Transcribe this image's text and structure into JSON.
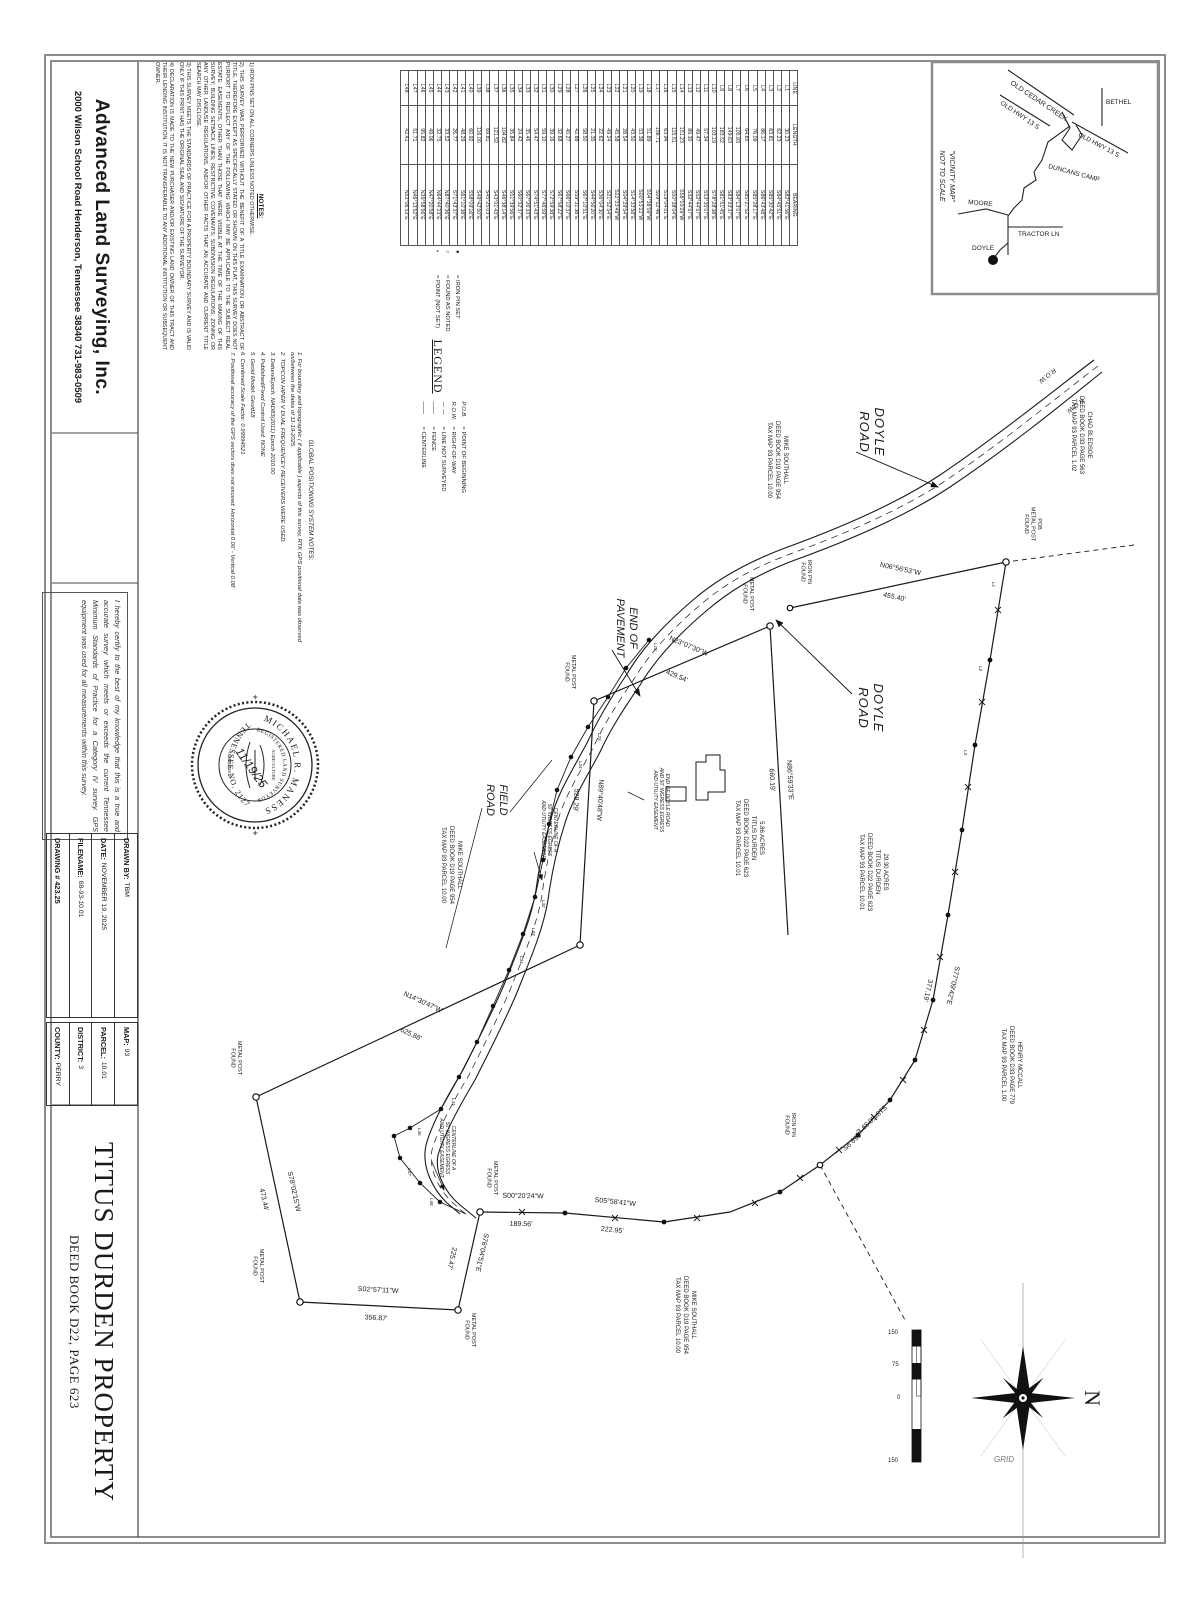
{
  "company": {
    "name": "Advanced Land Surveying, Inc.",
    "address": "2000 Wilson School Road   Henderson, Tennessee  38340    731-983-0509"
  },
  "notes": {
    "heading": "NOTES:",
    "items": [
      "1) IRON PINS SET ON ALL CORNERS UNLESS NOTED OTHERWISE.",
      "2) THIS SURVEY WAS PERFORMED WITHOUT THE BENEFIT OF A TITLE EXAMINATION OR ABSTRACT OF TITLE, THEREFORE EXCEPT AS SPECIFICALLY STATED OR SHOWN ON THIS PLAT, THIS SURVEY DOES NOT PURPORT TO REFLECT ANY OF THE FOLLOWING WHICH MAY BE APPLICABLE TO THE SUBJECT REAL ESTATE: EASEMENTS, OTHER THAN THOSE THAT WERE VISIBLE AT THE TIME OF THE MAKING OF THIS SURVEY; BUILDING SETBACK LINES; RESTRICTIVE COVENANTS; SUBDIVISION REGULATIONS; ZONING OR ANY OTHER LANDUSE REGULATIONS, AND/OR OTHER FACTS THAT AN ACCURATE AND CURRENT TITLE SEARCH MAY DISCLOSE.",
      "3) THIS SURVEY MEETS THE STANDARDS OF PRACTICE FOR A PROPERTY BOUNDARY SURVEY AND IS VALID ONLY IF THIS PRINT HAS THE ORIGINAL SEAL AND SIGNATURE OF THE SURVEYOR.",
      "4) DECLARATION IS MADE TO THE NEW PURCHASER AND/OR EXISTING LAND OWNER OF THIS TRACT AND THEIR LENDING INSTITUTION. IT IS NOT TRANSFERABLE TO ANY ADDITIONAL INSTITUTION OR SUBSEQUENT OWNER."
    ]
  },
  "gps_notes": {
    "heading": "GLOBAL POSITIONING SYSTEM NOTES:",
    "items": [
      "1.  For boundary and topographic ( if applicable ) aspects of this survey, RTK GPS positional data was observed on/between the dates of 11-19-2025.",
      "2.  TOPCON HIPER V DUAL FREQUENCEY RECEIVERS WERE USED.",
      "3.  Datum/Epoch:  NAD83(2011) Epoch 2010.00",
      "4.  Published/Fixed Control Used:  NONE",
      "5.  Geoid Model:   Geoid18",
      "6.  Combined Scale Factor:  0.99994521",
      "7.  Positional accuracy of the GPS vectors does not exceed:  Horizontal 0.06'  -  Vertical 0.08'"
    ]
  },
  "legend": {
    "heading": "LEGEND",
    "symbol_items": [
      {
        "sym": "●",
        "text": "= IRON PIN SET"
      },
      {
        "sym": "○",
        "text": "= FOUND AS NOTED"
      },
      {
        "sym": "•",
        "text": "= POINT (NOT SET)"
      }
    ],
    "abbrev_items": [
      {
        "sym": "P.O.B.",
        "text": "= POINT OF BEGINNING"
      },
      {
        "sym": "R.O.W.",
        "text": "= RIGHT-OF-WAY"
      },
      {
        "sym": "— —",
        "text": "= LINE NOT SURVEYED"
      },
      {
        "sym": "───",
        "text": "= FENCE"
      },
      {
        "sym": "───",
        "text": "= CENTERLINE"
      }
    ]
  },
  "line_table": {
    "headers": [
      "LINE",
      "LENGTH",
      "BEARING"
    ],
    "rows": [
      [
        "L1",
        "30.23",
        "S82°41'56\"E"
      ],
      [
        "L2",
        "62.23",
        "S84°45'51\"E"
      ],
      [
        "L3",
        "63.81",
        "S85°30'42\"E"
      ],
      [
        "L4",
        "86.17",
        "S86°43'48\"E"
      ],
      [
        "L5",
        "76.09",
        "S85°28'17\"E"
      ],
      [
        "L6",
        "64.65",
        "S85°27'52\"E"
      ],
      [
        "L7",
        "105.93",
        "S84°13'07\"E"
      ],
      [
        "L8",
        "149.63",
        "S83°33'37\"E"
      ],
      [
        "L9",
        "183.52",
        "S81°51'45\"E"
      ],
      [
        "L10",
        "103.19",
        "S78°28'38\"E"
      ],
      [
        "L11",
        "57.34",
        "S53°35'07\"E"
      ],
      [
        "L12",
        "49.47",
        "S52°44'57\"E"
      ],
      [
        "L13",
        "89.30",
        "S32°44'57\"E"
      ],
      [
        "L14",
        "151.23",
        "S58°03'29\"W"
      ],
      [
        "L15",
        "115.51",
        "S50°38'04\"E"
      ],
      [
        "L16",
        "63.94",
        "S19°04'01\"E"
      ],
      [
        "L17",
        "156.71",
        "S09°52'46\"E"
      ],
      [
        "L18",
        "51.89",
        "S04°38'09\"W"
      ],
      [
        "L19",
        "53.38",
        "S00°53'22\"W"
      ],
      [
        "L20",
        "43.50",
        "S14°33'58\"E"
      ],
      [
        "L21",
        "28.54",
        "S04°29'54\"E"
      ],
      [
        "L22",
        "45.58",
        "S22°23'49\"W"
      ],
      [
        "L23",
        "49.24",
        "S21°52'54\"E"
      ],
      [
        "L24",
        "22.62",
        "S36°04'30\"E"
      ],
      [
        "L25",
        "21.35",
        "S44°56'20\"E"
      ],
      [
        "L26",
        "58.50",
        "S67°10'51\"E"
      ],
      [
        "L27",
        "42.88",
        "S59°31'38\"E"
      ],
      [
        "L28",
        "40.27",
        "S66°10'37\"E"
      ],
      [
        "L29",
        "32.68",
        "S67°58'22\"E"
      ],
      [
        "L30",
        "39.16",
        "S72°59'38\"E"
      ],
      [
        "L31",
        "59.10",
        "S77°46'59\"E"
      ],
      [
        "L32",
        "54.47",
        "S74°51'43\"E"
      ],
      [
        "L33",
        "35.46",
        "S67°26'33\"E"
      ],
      [
        "L34",
        "24.42",
        "S60°32'37\"E"
      ],
      [
        "L35",
        "35.84",
        "S51°39'56\"E"
      ],
      [
        "L36",
        "104.82",
        "S46°38'14\"E"
      ],
      [
        "L37",
        "121.52",
        "S43°01'43\"E"
      ],
      [
        "L38",
        "69.81",
        "S45°25'03\"E"
      ],
      [
        "L39",
        "116.00",
        "S49°42'50\"E"
      ],
      [
        "L40",
        "60.92",
        "S58°09'16\"E"
      ],
      [
        "L41",
        "48.29",
        "S61°10'38\"E"
      ],
      [
        "L42",
        "26.77",
        "S71°43'37\"E"
      ],
      [
        "L43",
        "33.52",
        "N87°40'36\"E"
      ],
      [
        "L44",
        "32.75",
        "N64°44'23\"E"
      ],
      [
        "L45",
        "49.06",
        "N47°20'58\"E"
      ],
      [
        "L46",
        "95.82",
        "N39°58'56\"E"
      ],
      [
        "L47",
        "51.71",
        "N46°13'52\"E"
      ],
      [
        "L48",
        "42.41",
        "N53°06'53\"E"
      ]
    ]
  },
  "vicinity": {
    "caption1": "\"VICINITY MAP\"",
    "caption2": "NOT TO SCALE",
    "roads": {
      "old_cedar_creek": "OLD CEDAR CREEK",
      "old_hwy_1": "OLD HWY 13 S",
      "old_hwy_2": "OLD HWY 13 S",
      "bethel": "BETHEL",
      "duncans_camp": "DUNCANS CAMP",
      "moore": "MOORE",
      "tractor_ln": "TRACTOR LN",
      "doyle": "DOYLE"
    }
  },
  "certification": "I hereby certify to the best of my knowledge that this is a true and accurate survey which meets or exceeds the current Tennessee Minimum Standards of Practice for a Category IV survey. GPS equipment was used for all measurements within this survey.",
  "seal": {
    "name": "MICHAEL R. MANESS",
    "reg": "REGISTERED LAND SURVEYOR",
    "state": "TENNESSEE NO. 2127",
    "agriculture": "AGRICULTURE",
    "commerce": "COMMERCE",
    "date": "11/19/25",
    "plus": "+"
  },
  "title_block": {
    "drawn_by_label": "DRAWN BY:",
    "drawn_by": "TBM",
    "date_label": "DATE:",
    "date": "NOVEMBER 19, 2025",
    "filename_label": "FILENAME:",
    "filename": "68-93-10.01",
    "drawing_no": "DRAWING # 423.25",
    "map_label": "MAP:",
    "map": "93",
    "parcel_label": "PARCEL:",
    "parcel": "10.01",
    "district_label": "DISTRICT:",
    "district": "3",
    "county_label": "COUNTY:",
    "county": "PERRY"
  },
  "title": {
    "line1": "TITUS DURDEN PROPERTY",
    "line2": "DEED BOOK D22, PAGE 623"
  },
  "compass": {
    "north": "N",
    "grid": "GRID"
  },
  "scale_bar": {
    "labels": [
      "150",
      "75",
      "0",
      "150"
    ]
  },
  "drawing": {
    "labels": {
      "doyle_road": [
        "DOYLE",
        "ROAD"
      ],
      "field_road": [
        "FIELD",
        "ROAD"
      ],
      "end_of_pavement": [
        "END OF",
        "PAVEMENT"
      ],
      "row_label": "R.O.W.",
      "pob": [
        "POB",
        "METAL POST",
        "FOUND"
      ],
      "metal_post": [
        "METAL POST",
        "FOUND"
      ],
      "iron_pin": [
        "IRON PIN",
        "FOUND"
      ],
      "easement_cl": [
        "CENTERLINE OF A",
        "50' INGRESS EGRESS",
        "AND UTILITY EASEMENT"
      ],
      "end_easement": [
        "END OF DOYLE ROAD",
        "AND 50' INGRESS EGRESS",
        "AND UTILITY EASEMENT"
      ]
    },
    "parcels": {
      "chad_bledsoe": [
        "CHAD BLEDSOE",
        "DEED BOOK D33 PAGE 563",
        "TAX MAP 93 PARCEL 1.02"
      ],
      "mike_southall": [
        "MIKE SOUTHALL",
        "DEED BOOK D19 PAGE 954",
        "TAX MAP 93 PARCEL 10.00"
      ],
      "henry_mccall": [
        "HENRY MCCALL",
        "DEED BOOK D33 PAGE 779",
        "TAX MAP 93 PARCEL 1.00"
      ],
      "titus_29": [
        "29.30 ACRES",
        "TITUS DURDEN",
        "DEED BOOK D22 PAGE 623",
        "TAX MAP 93 PARCEL 10.01"
      ],
      "titus_5": [
        "5.86 ACRES",
        "TITUS DURDEN",
        "DEED BOOK D22 PAGE 623",
        "TAX MAP 93 PARCEL 10.01"
      ]
    },
    "bearings": {
      "n06": {
        "b": "N06°56'53\"W",
        "d": "455.40'"
      },
      "n23": {
        "b": "N23°07'30\"W",
        "d": "429.54'"
      },
      "n86": {
        "b": "N86°59'33\"E",
        "d": "660.19'"
      },
      "n89": {
        "b": "N89°40'48\"W",
        "d": "529.29'"
      },
      "n14": {
        "b": "N14°30'47\"W",
        "d": "625.88'"
      },
      "s78": {
        "b": "S78°02'15\"W",
        "d": "473.44'"
      },
      "s02": {
        "b": "S02°57'11\"W",
        "d": "356.87'"
      },
      "s76": {
        "b": "S76°04'51\"E",
        "d": "225.47'"
      },
      "s00": {
        "b": "S00°20'24\"W",
        "d": "189.56'"
      },
      "s05": {
        "b": "S05°58'41\"W",
        "d": "222.95'"
      },
      "s77": {
        "b": "S77°09'42\"E",
        "d": "377.19'"
      },
      "s18": {
        "b": "S18°50'39\"E",
        "d": "369.95'"
      }
    },
    "l_labels": {
      "l1": "L1",
      "l2": "L2",
      "l3": "L3",
      "l13": "L13",
      "l23": "L23",
      "l24": "L24",
      "l32": "L32",
      "l33": "L33",
      "l34": "L34",
      "l44": "L44",
      "l46": "L46",
      "l47": "L47",
      "l48": "L48"
    }
  }
}
